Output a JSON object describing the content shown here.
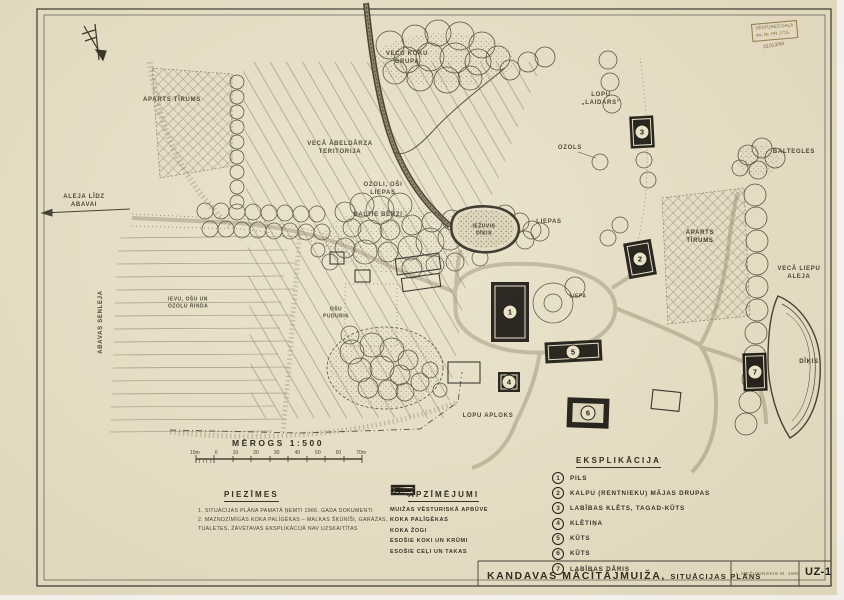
{
  "doc": {
    "title": "KANDAVAS MĀCĪTĀJMUIŽA,",
    "subtitle": "SITUĀCIJAS PLĀNS",
    "credit": "I. MEŽURINSKIS M. 1966",
    "sheet": "UZ-1"
  },
  "stamp": {
    "line1": "VĒSTURES DAĻA",
    "line2": "inv. Nr. PR 1715",
    "line3": "31013/96"
  },
  "scale": {
    "title": "MĒROGS 1:500",
    "ticks": [
      "10m",
      "0",
      "10",
      "20",
      "30",
      "40",
      "50",
      "60",
      "70m"
    ]
  },
  "notes": {
    "heading": "PIEZĪMES",
    "items": [
      "1. SITUĀCIJAS PLĀNA PAMATĀ ŅEMTI 1966. GADA DOKUMENTI",
      "2. MAZNOZĪMĪGĀS KOKA PALĪGĒKAS – MALKAS ŠĶŪNĪŠI, GARĀŽAS,\nTUALETES, ŽĀVĒTAVAS EKSPLIKĀCIJĀ NAV UZSKAITĪTAS"
    ]
  },
  "legend": {
    "heading": "APZĪMĒJUMI",
    "items": [
      {
        "symbol": "filled-building",
        "label": "MUIŽAS VĒSTURISKĀ APBŪVE"
      },
      {
        "symbol": "open-building",
        "label": "KOKA PALĪGĒKAS"
      },
      {
        "symbol": "fence",
        "label": "KOKA ŽOGI"
      },
      {
        "symbol": "trees-shrubs",
        "label": "ESOŠIE KOKI UN KRŪMI"
      },
      {
        "symbol": "roads-paths",
        "label": "ESOŠIE CEĻI UN TAKAS"
      }
    ]
  },
  "explication": {
    "heading": "EKSPLIKĀCIJA",
    "items": [
      {
        "num": "1",
        "label": "PILS"
      },
      {
        "num": "2",
        "label": "KALPU (RENTNIEKU) MĀJAS DRUPAS"
      },
      {
        "num": "3",
        "label": "LABĪBAS KLĒTS, TAGAD-KŪTS"
      },
      {
        "num": "4",
        "label": "KLĒTIŅA"
      },
      {
        "num": "5",
        "label": "KŪTS"
      },
      {
        "num": "6",
        "label": "KŪTS"
      },
      {
        "num": "7",
        "label": "LABĪBAS DĀRIS"
      }
    ]
  },
  "map": {
    "colors": {
      "paper": "#e9e1c8",
      "ink": "#3a352a",
      "road_dark": "#3a3427",
      "hatch": "#8d8468"
    },
    "labels": {
      "field_left": "APARTS TĪRUMS",
      "old_tree_group": "VECU KOKU\nGRUPA",
      "orchard": "VECĀ ĀBELDĀRZA\nTERITORIJA",
      "oaks_ashes": "OZOLI, OŠI\nLIEPAS",
      "white_birches": "BALTIE BĒRZI",
      "dried_pond": "IEŽUVIS\nDĪĶIS",
      "lindens": "LIEPAS",
      "cattle_yard": "LOPU\n„LAIDARS”",
      "oak": "OZOLS",
      "white_firs": "BALTEGLES",
      "field_right": "APARTS\nTĪRUMS",
      "old_linden_alley": "VECĀ LIEPU\nALEJA",
      "pond": "DĪĶIS",
      "alley_to_abava": "ALEJA LĪDZ\nABAVAI",
      "abava_valley": "ABAVAS SENLEJA",
      "tree_row": "IEVU, OŠU UN\nOZOLU RINDA",
      "ash_grove": "OŠU\nPUDURIS",
      "linden": "LIEPA",
      "cattle_paddock": "LOPU APLOKS"
    }
  }
}
